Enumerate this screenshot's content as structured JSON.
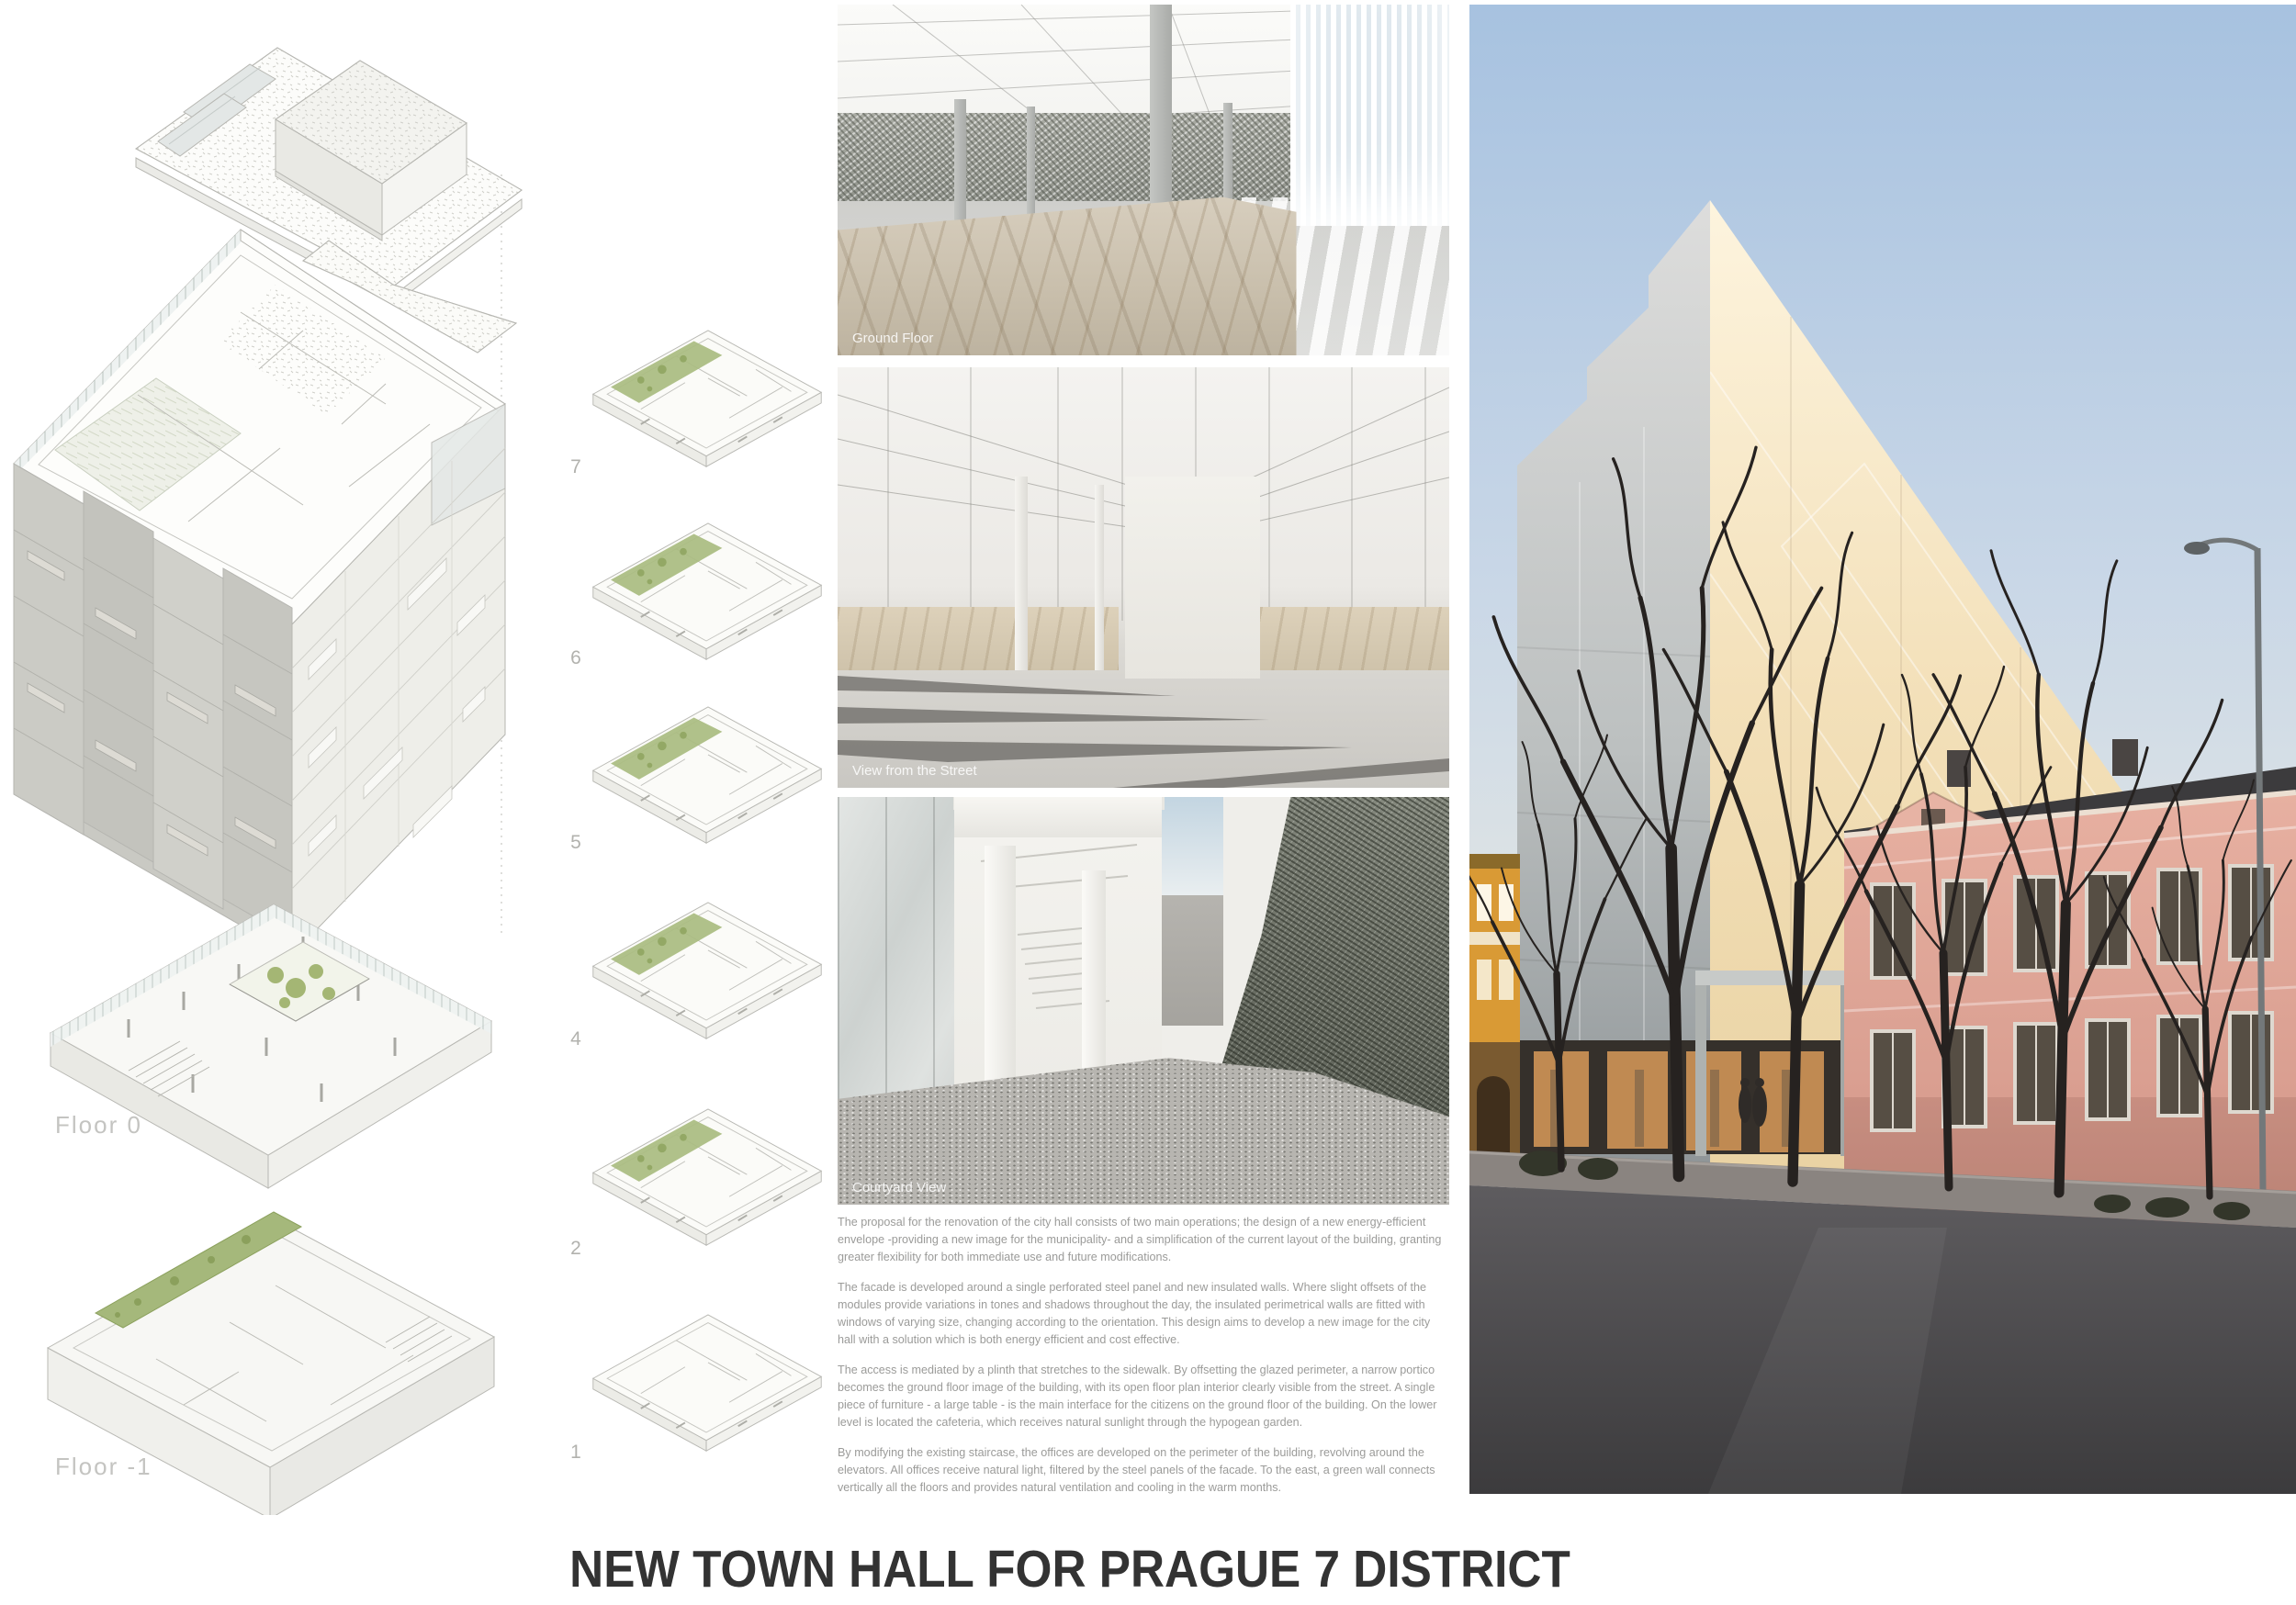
{
  "board": {
    "title": "NEW TOWN HALL FOR PRAGUE 7 DISTRICT"
  },
  "exploded_axon": {
    "floor0_label": "Floor 0",
    "floor_minus1_label": "Floor -1"
  },
  "floor_plans": {
    "items": [
      {
        "label": "7"
      },
      {
        "label": "6"
      },
      {
        "label": "5"
      },
      {
        "label": "4"
      },
      {
        "label": "2"
      },
      {
        "label": "1"
      }
    ]
  },
  "renders": [
    {
      "caption": "Ground Floor"
    },
    {
      "caption": "View from the Street"
    },
    {
      "caption": "Courtyard View"
    }
  ],
  "description": {
    "paragraphs": [
      "The proposal for the renovation of the city hall consists of two main operations; the design of a new energy-efficient envelope -providing a new image for the municipality- and a simplification of the current layout of the building, granting greater flexibility for both immediate use and future modifications.",
      "The facade is developed around a single perforated steel panel and new insulated walls. Where slight offsets of the modules provide variations in tones and shadows throughout the day, the insulated perimetrical walls are fitted with windows of varying size, changing according to the orientation. This design aims to develop a new image for the city hall with a solution which is both energy efficient and cost effective.",
      "The access is mediated by a plinth that stretches to the sidewalk. By offsetting the glazed perimeter, a narrow portico becomes the ground floor image of the building, with its open floor plan interior clearly visible from the street. A single piece of furniture - a large table - is the main interface for the citizens on the ground floor of the building. On the lower level is located the cafeteria, which receives natural sunlight through the hypogean garden.",
      "By modifying the existing staircase, the offices are developed on the perimeter of the building, revolving around the elevators. All offices receive natural light, filtered by the steel panels of the facade. To the east, a green wall connects vertically all the floors and provides natural ventilation and cooling in the warm months."
    ]
  },
  "colors": {
    "paper": "#ffffff",
    "title_text": "#333333",
    "body_text": "#9b9b99",
    "drawing_line": "#b5b5b0",
    "garden_green": "#a9bc80",
    "marble_beige": "#cfc5b2",
    "facade_cream": "#f3e2bc",
    "sky_blue": "#aec6e2",
    "heritage_pink": "#e0a698",
    "heritage_orange": "#d99a35"
  }
}
